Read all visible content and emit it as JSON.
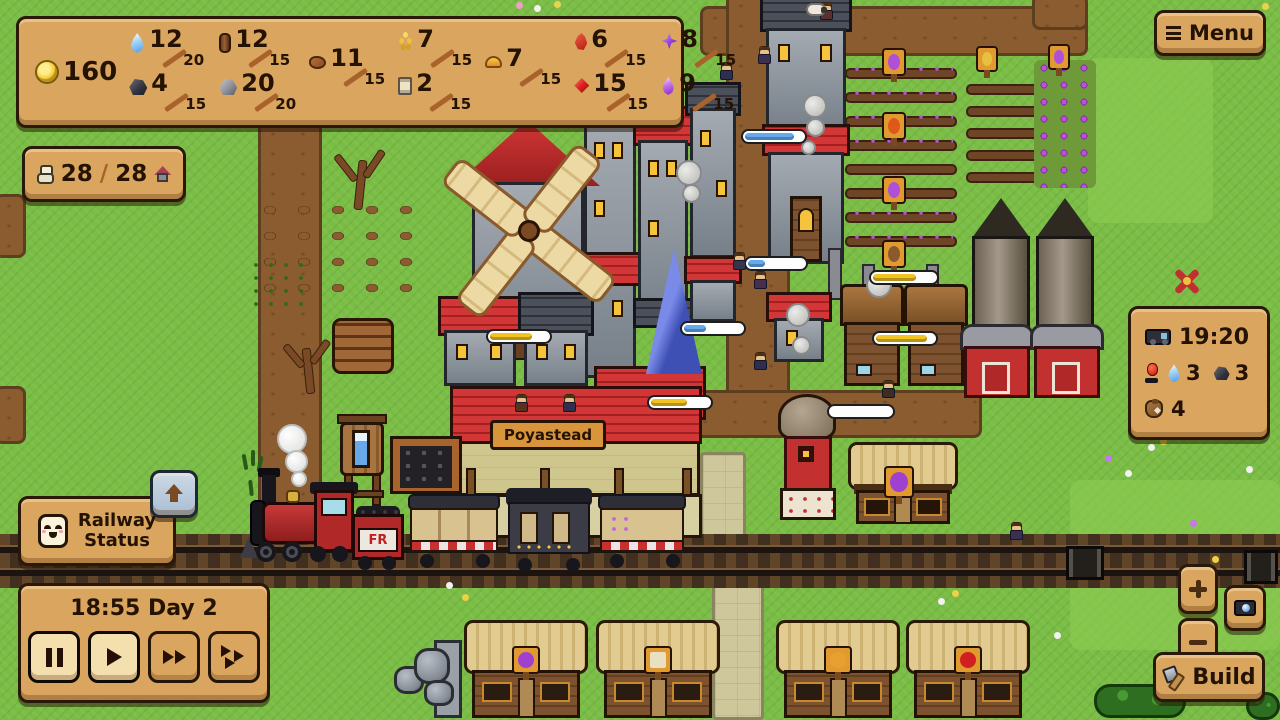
{
  "ui": {
    "coins": "160",
    "menu_button": {
      "label": "Menu",
      "icon": "hamburger"
    },
    "build_button": {
      "label": "Build",
      "icon": "hammer"
    },
    "railway_status_button": {
      "line1": "Railway",
      "line2": "Status",
      "icon": "smiley-face"
    },
    "collapse_button": {
      "icon": "up-arrow"
    },
    "time_panel": {
      "datetime": "18:55 Day 2",
      "buttons": [
        "pause",
        "play",
        "fast-forward",
        "fastest"
      ]
    },
    "population": {
      "current": "28",
      "separator": "/",
      "max": "28",
      "left_icon": "villager",
      "right_icon": "house"
    },
    "train_panel": {
      "arrival_time": "19:20",
      "water_count": "3",
      "coal_count": "3",
      "cargo_count": "4",
      "icons": [
        "train",
        "signal",
        "water-drop",
        "coal",
        "sack"
      ]
    },
    "map_controls": {
      "zoom_in": "plus",
      "zoom_out": "minus",
      "screenshot": "camera"
    }
  },
  "resources": [
    {
      "name": "water",
      "icon": "water-drop",
      "value": "12",
      "max": "20"
    },
    {
      "name": "wood",
      "icon": "log",
      "value": "12",
      "max": "15"
    },
    {
      "name": "coal",
      "icon": "coal-lump",
      "value": "4",
      "max": "15"
    },
    {
      "name": "stone",
      "icon": "stone-lump",
      "value": "20",
      "max": "20"
    },
    {
      "name": "clay",
      "icon": "clay-lump",
      "value": "11",
      "max": "15"
    },
    {
      "name": "wheat",
      "icon": "wheat-grain",
      "value": "7",
      "max": "15"
    },
    {
      "name": "paper",
      "icon": "scroll",
      "value": "2",
      "max": "15"
    },
    {
      "name": "bread",
      "icon": "bread-bun",
      "value": "7",
      "max": "15"
    },
    {
      "name": "pepper",
      "icon": "red-pepper",
      "value": "6",
      "max": "15"
    },
    {
      "name": "ruby",
      "icon": "red-gem",
      "value": "15",
      "max": "15"
    },
    {
      "name": "amethyst",
      "icon": "purple-gem",
      "value": "8",
      "max": "15"
    },
    {
      "name": "elixir",
      "icon": "purple-droplet",
      "value": "9",
      "max": "15"
    }
  ],
  "scene": {
    "station_sign": "Poyastead",
    "tender_logo": "FR"
  },
  "progress_bars": [
    {
      "pct": 72,
      "color": "yellow",
      "color_hex": "#f2c422"
    },
    {
      "pct": 62,
      "color": "yellow",
      "color_hex": "#f2c422"
    },
    {
      "pct": 70,
      "color": "yellow",
      "color_hex": "#f2c422"
    },
    {
      "pct": 88,
      "color": "yellow",
      "color_hex": "#f2c422"
    },
    {
      "pct": 38,
      "color": "blue",
      "color_hex": "#66aaee"
    },
    {
      "pct": 30,
      "color": "blue",
      "color_hex": "#66aaee"
    },
    {
      "pct": 85,
      "color": "blue",
      "color_hex": "#66aaee"
    },
    {
      "pct": 0,
      "color": "empty",
      "color_hex": "#ffffff"
    }
  ],
  "colors": {
    "panel": "#d9a55f",
    "panel_border": "#2a1808",
    "text": "#241203",
    "grass": "#79bd44",
    "path": "#8a5c30",
    "bar_yellow": "#f2c422",
    "bar_blue": "#66aaee",
    "accent_red": "#c23030"
  }
}
